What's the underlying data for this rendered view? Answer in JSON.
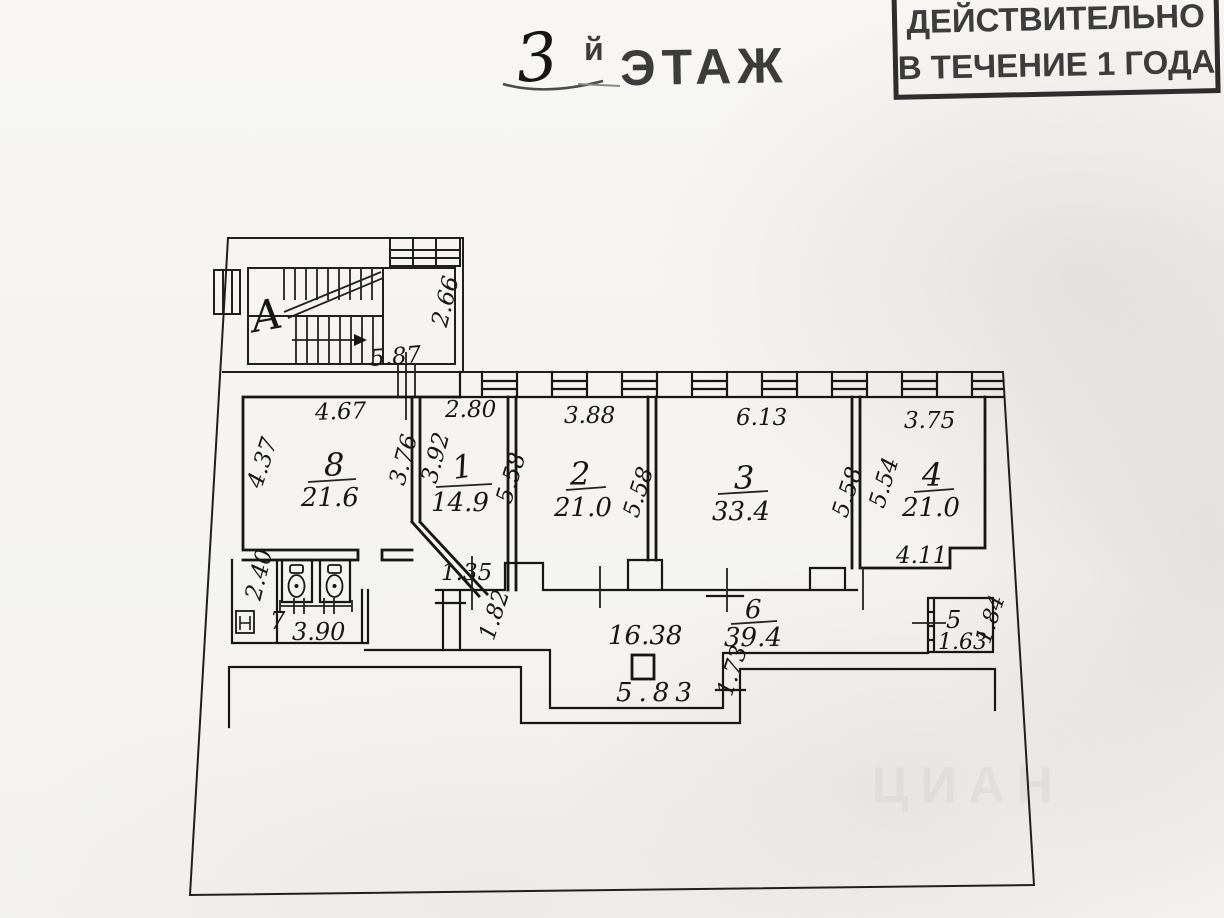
{
  "title": {
    "number": "3",
    "suffix": "й",
    "word": "ЭТАЖ"
  },
  "stamp": {
    "line1": "ДЕЙСТВИТЕЛЬНО",
    "line2": "В ТЕЧЕНИЕ 1 ГОДА"
  },
  "watermark": "ЦИАН",
  "stair": {
    "label": "А",
    "dim_width": "5.87",
    "dim_depth": "2.66"
  },
  "rooms": {
    "8": {
      "number": "8",
      "area": "21.6",
      "dim_top": "4.67",
      "dim_left": "4.37",
      "dim_right": "3.76"
    },
    "1": {
      "number": "1",
      "area": "14.9",
      "dim_top": "2.80",
      "dim_left": "3.92",
      "dim_right": "5.58"
    },
    "2": {
      "number": "2",
      "area": "21.0",
      "dim_top": "3.88",
      "dim_right": "5.58"
    },
    "3": {
      "number": "3",
      "area": "33.4",
      "dim_top": "6.13",
      "dim_right": "5.58"
    },
    "4": {
      "number": "4",
      "area": "21.0",
      "dim_top": "3.75",
      "dim_left": "5.54",
      "dim_bottom": "4.11"
    },
    "5": {
      "number": "5",
      "area": "1.63",
      "dim_right": "1.84"
    },
    "6": {
      "number": "6",
      "area": "39.4"
    },
    "7": {
      "number": "7",
      "dim_width": "3.90",
      "dim_depth": "2.40"
    }
  },
  "corridor": {
    "area": "16.38",
    "dim_recess": "5.83",
    "dim_step": "1.73",
    "dim_left": "1.82",
    "dim_door": "1.35"
  },
  "colors": {
    "ink": "#161616",
    "stamp_ink": "#3c3c3c",
    "paper": "#f5f4f1"
  }
}
